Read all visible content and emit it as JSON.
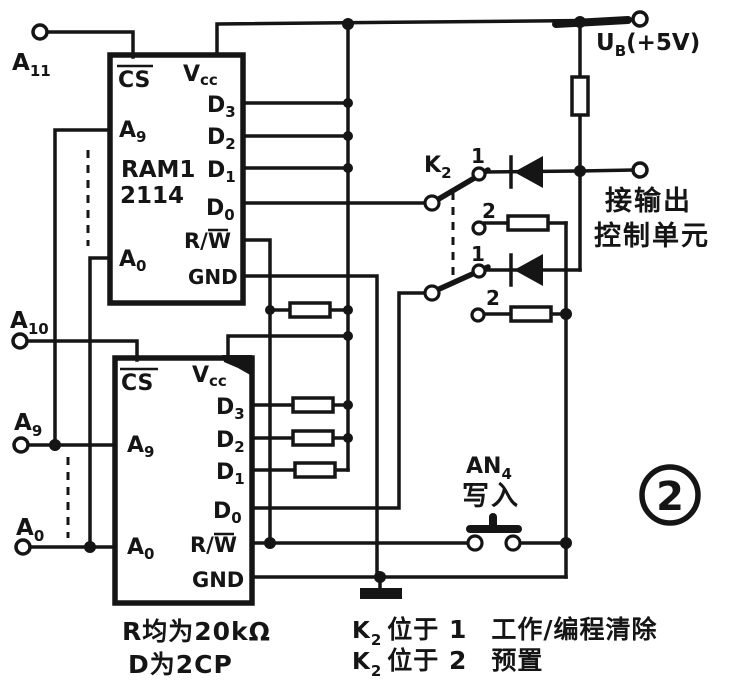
{
  "colors": {
    "ink": "#151515",
    "paper": "#ffffff"
  },
  "terminals": {
    "a11": {
      "base": "A",
      "sub": "11"
    },
    "a10": {
      "base": "A",
      "sub": "10"
    },
    "a9": {
      "base": "A",
      "sub": "9"
    },
    "a0": {
      "base": "A",
      "sub": "0"
    },
    "ub": {
      "base": "U",
      "sub": "B",
      "suffix": "(+5V)"
    },
    "output_control": {
      "line1": "接输出",
      "line2": "控制单元"
    }
  },
  "chips": {
    "ram1": {
      "title1": "RAM1",
      "title2": "2114",
      "cs": "CS",
      "vcc": {
        "base": "V",
        "sub": "cc"
      },
      "a9": {
        "base": "A",
        "sub": "9"
      },
      "a0": {
        "base": "A",
        "sub": "0"
      },
      "d3": {
        "base": "D",
        "sub": "3"
      },
      "d2": {
        "base": "D",
        "sub": "2"
      },
      "d1": {
        "base": "D",
        "sub": "1"
      },
      "d0": {
        "base": "D",
        "sub": "0"
      },
      "rw": {
        "pre": "R/",
        "w": "W"
      },
      "gnd": "GND"
    },
    "ram2": {
      "cs": "CS",
      "vcc": {
        "base": "V",
        "sub": "cc"
      },
      "a9": {
        "base": "A",
        "sub": "9"
      },
      "a0": {
        "base": "A",
        "sub": "0"
      },
      "d3": {
        "base": "D",
        "sub": "3"
      },
      "d2": {
        "base": "D",
        "sub": "2"
      },
      "d1": {
        "base": "D",
        "sub": "1"
      },
      "d0": {
        "base": "D",
        "sub": "0"
      },
      "rw": {
        "pre": "R/",
        "w": "W"
      },
      "gnd": "GND"
    }
  },
  "switch_k2": {
    "label": {
      "base": "K",
      "sub": "2"
    },
    "pos1": "1",
    "pos2": "2"
  },
  "button_an4": {
    "label": {
      "base": "AN",
      "sub": "4"
    },
    "caption": "写入"
  },
  "figure_badge": "2",
  "notes": {
    "r_note": "R均为20kΩ",
    "d_note": "D为2CP",
    "k_note1": {
      "base": "K",
      "sub": "2",
      "mid": "位于 1",
      "normal": "工作/",
      "bold": "编程清除"
    },
    "k_note2": {
      "base": "K",
      "sub": "2",
      "mid": "位于 2",
      "bold": "预置"
    }
  }
}
